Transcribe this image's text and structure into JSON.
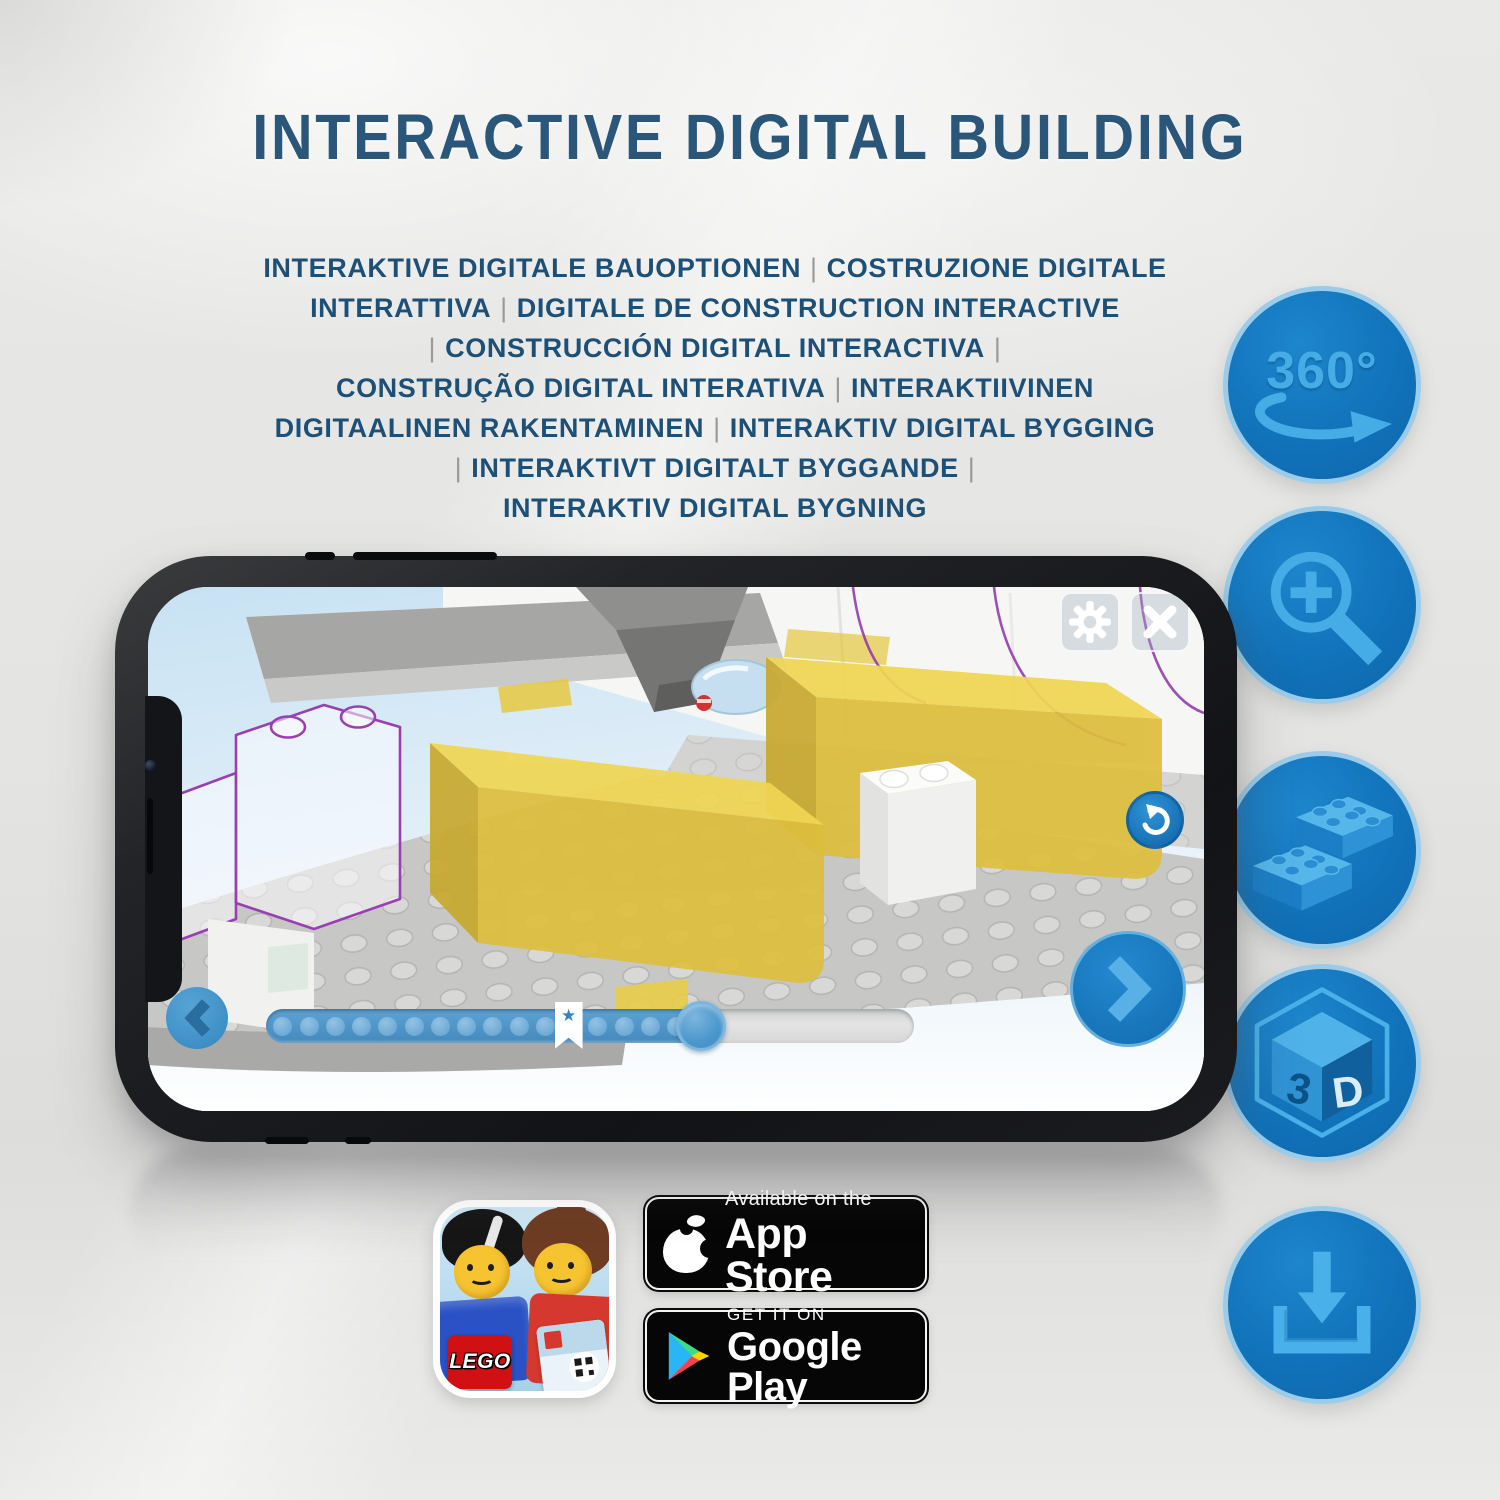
{
  "title": {
    "text": "INTERACTIVE DIGITAL BUILDING"
  },
  "subtitle": {
    "lines": [
      "INTERAKTIVE DIGITALE BAUOPTIONEN | COSTRUZIONE DIGITALE",
      "INTERATTIVA | DIGITALE DE CONSTRUCTION INTERACTIVE",
      "| CONSTRUCCIÓN DIGITAL INTERACTIVA |",
      "CONSTRUÇÃO DIGITAL INTERATIVA | INTERAKTIIVINEN",
      "DIGITAALINEN RAKENTAMINEN | INTERAKTIV DIGITAL BYGGING",
      "| INTERAKTIVT DIGITALT BYGGANDE |",
      "INTERAKTIV DIGITAL BYGNING"
    ]
  },
  "feature_icons": [
    {
      "name": "360-rotation-icon",
      "label": "360°"
    },
    {
      "name": "zoom-in-magnifier-icon"
    },
    {
      "name": "lego-brick-icon"
    },
    {
      "name": "3d-cube-icon",
      "face_left": "3",
      "face_right": "D"
    },
    {
      "name": "download-icon"
    }
  ],
  "phone": {
    "screen_ui": {
      "settings_icon": "gear",
      "close_icon": "x",
      "rotate_view_icon": "rotate-arrow",
      "previous_icon": "chevron-left",
      "next_icon": "chevron-right"
    },
    "progress": {
      "dot_count": 17,
      "fill_fraction": 0.7,
      "star_fraction": 0.467,
      "handle_fraction": 0.671,
      "star_glyph": "★"
    }
  },
  "app_icon": {
    "brand": "LEGO"
  },
  "badges": {
    "app_store": {
      "tagline": "Available on the",
      "store": "App Store"
    },
    "google_play": {
      "tagline": "GET IT ON",
      "store": "Google Play"
    }
  },
  "colors": {
    "title_blue": "#2a567a",
    "subtitle_blue": "#1d5077",
    "separator_gray": "#9a9a9a",
    "accent_blue": "#1173ba",
    "icon_glyph_blue": "#45ace6",
    "lego_yellow": "#eccf4b",
    "badge_black": "#060606"
  }
}
